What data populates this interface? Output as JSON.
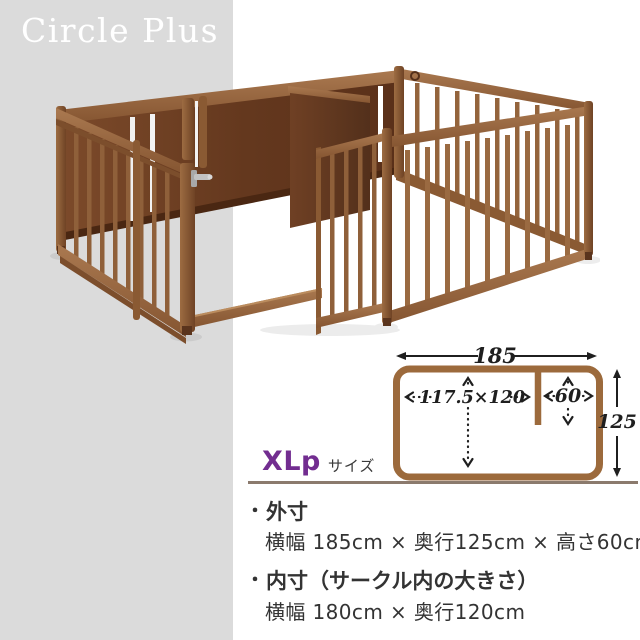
{
  "brand": {
    "name": "Circle Plus"
  },
  "size_label": {
    "code": "XLp",
    "suffix": "サイズ"
  },
  "diagram": {
    "outer_width_label": "185",
    "inner_dims_label": "117.5×120",
    "section_width_label": "60",
    "outer_depth_label": "125"
  },
  "specs": {
    "bullet": "・",
    "items": [
      {
        "title": "外寸",
        "detail": "横幅 185cm × 奥行125cm × 高さ60cm"
      },
      {
        "title": "内寸（サークル内の大きさ）",
        "detail": "横幅 180cm × 奥行120cm"
      }
    ]
  },
  "colors": {
    "background_band": "#dbdbdb",
    "wood_light": "#9a6a41",
    "wood_panel_dark": "#5f3a1f",
    "diagram_outline": "#9c6a3c",
    "size_accent": "#722d90",
    "rule": "#8b7a6d",
    "text": "#333333"
  }
}
